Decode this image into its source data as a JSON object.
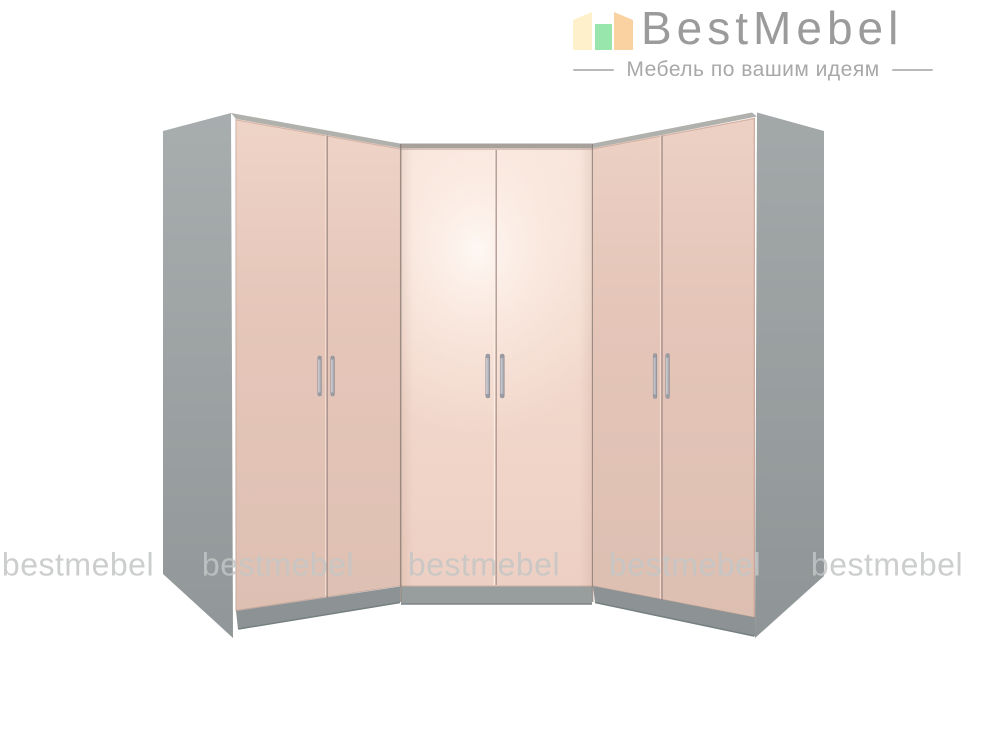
{
  "page": {
    "background_color": "#ffffff",
    "width": 1000,
    "height": 750
  },
  "header": {
    "logo": {
      "brand": "BestMebel",
      "tagline": "Мебель по вашим идеям",
      "brand_color": "#9b9b9b",
      "tagline_color": "#a8a8a8",
      "icon_bar_colors": [
        "#fdf0cb",
        "#98e6ac",
        "#fad2a2"
      ]
    }
  },
  "watermarks": {
    "text": "bestmebel",
    "count": 5,
    "color": "#c4c6c6"
  },
  "product_image": {
    "alt": "Corner wardrobe set: two angled double-door wardrobes and a front-facing corner unit, pink gloss doors, grey carcass and plinth",
    "colors": {
      "carcass_grey": "#9ca1a2",
      "plinth_grey": "#8d9394",
      "top_strip_grey": "#b0b1ad",
      "corner_top_strip": "#a8a19b",
      "center_plinth_grey": "#989e9e",
      "door_pink": "#e4c5b8",
      "door_pink_highlight": "#f9ece4",
      "handle_silver": "#c2c2c8"
    }
  }
}
